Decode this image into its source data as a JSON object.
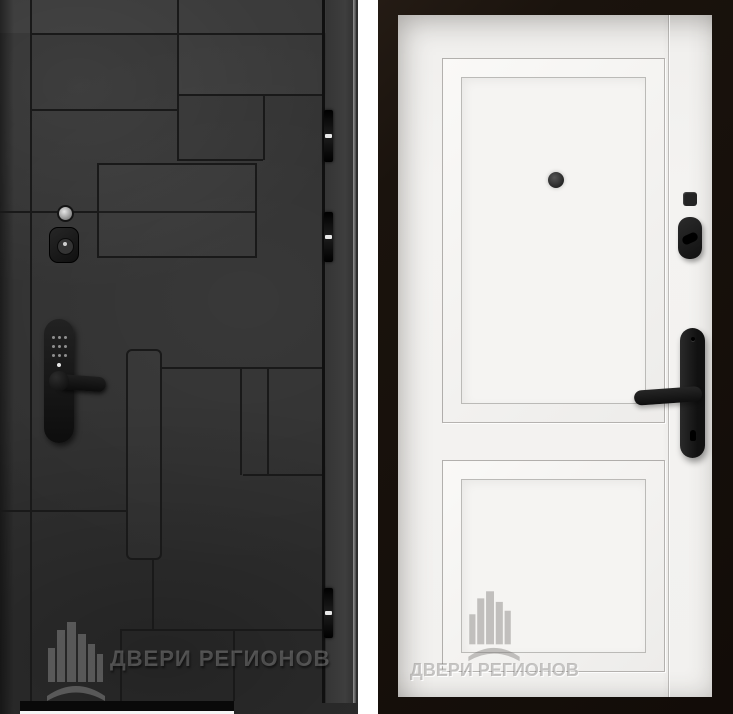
{
  "brand": {
    "watermark_text": "ДВЕРИ РЕГИОНОВ",
    "logo": "city-buildings-with-swoosh"
  },
  "colors": {
    "page-bg": "#ffffff",
    "left-finish": "#313131",
    "left-groove": "#191919",
    "hardware-black": "#171717",
    "left-edge-highlight": "#b5b5b5",
    "right-frame": "#1a130d",
    "right-leaf": "#f4f3f1",
    "right-panel-line": "#9c9a97",
    "right-hardware": "#1e1e1e",
    "watermark-on-dark": "rgba(205,205,205,0.30)",
    "watermark-on-light": "rgba(115,113,110,0.40)"
  },
  "left_door": {
    "side": "exterior",
    "hinge_count": 3,
    "hardware": [
      "peephole",
      "cylinder-lock",
      "smart-lock-keypad-lever"
    ]
  },
  "right_door": {
    "side": "interior",
    "panel_count": 2,
    "hardware": [
      "peephole",
      "deadbolt-indicator",
      "thumbturn",
      "lever-handle-backplate"
    ]
  }
}
